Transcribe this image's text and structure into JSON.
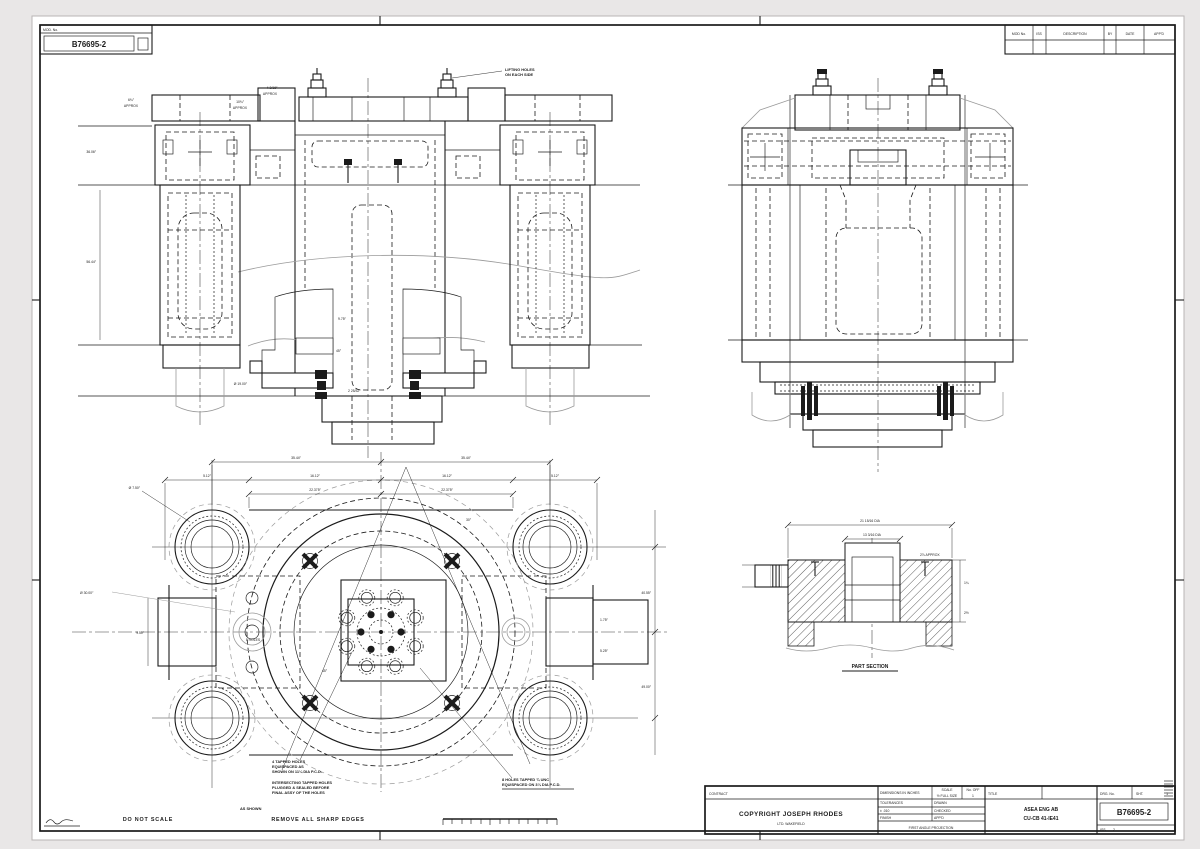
{
  "page": {
    "background": "#e9e7e7",
    "paper": "#ffffff",
    "ink": "#1b1b1b",
    "gray": "#9b9b9b"
  },
  "corner_box": {
    "label": "MOD. No.",
    "number": "B76695-2"
  },
  "revision_table": {
    "headers": [
      "MOD No.",
      "ISS",
      "DESCRIPTION",
      "BY",
      "DATE",
      "APP'D"
    ]
  },
  "title_block": {
    "contract_label": "CONTRACT",
    "copyright_line1": "COPYRIGHT JOSEPH RHODES",
    "copyright_line2": "LTD. WAKEFIELD",
    "dims_note": "DIMENSIONS IN INCHES",
    "scale_label": "SCALE",
    "scale_value": "½ FULL SIZE",
    "no_off_label": "No. OFF",
    "no_off_value": "1",
    "tol_label": "TOLERANCES",
    "tol_value": "± .010",
    "finish_label": "FINISH",
    "drawn_label": "DRAWN",
    "checked_label": "CHECKED",
    "approved_label": "APP'D",
    "projection_note": "FIRST ANGLE PROJECTION",
    "title_label": "TITLE",
    "customer_line1": "ASEA ENG AB",
    "customer_line2": "CU-CB 41-IE41",
    "drg_label": "DRG. No.",
    "drg_no": "B76695-2",
    "sheet_label": "SHT.",
    "sheet_value": "1",
    "issue_label": "ISS.",
    "issue_value": "2"
  },
  "footer": {
    "do_not_scale": "DO NOT SCALE",
    "remove_edges": "REMOVE ALL SHARP EDGES"
  },
  "notes": {
    "lifting": [
      "LIFTING HOLES",
      "ON EACH SIDE"
    ],
    "tapped": [
      "4 TAPPED HOLES",
      "EQUISPACED AS",
      "SHOWN ON 11¼ DIA P.C.D."
    ],
    "plugged": [
      "INTERSECTING TAPPED HOLES",
      "PLUGGED & SEALED BEFORE",
      "FINAL ASSY OF THE HOLES",
      "AS SHOWN"
    ],
    "holes8": [
      "8 HOLES TAPPED ¾ UNC",
      "EQUISPACED ON 3¼ DIA P.C.D."
    ]
  },
  "front_view": {
    "dims": {
      "approx1_a": "6¾″",
      "approx1_b": "APPROX",
      "approx2_a": "10¾″",
      "approx2_b": "APPROX",
      "approx3_a": "4 3/16″",
      "approx3_b": "APPROX",
      "left1": "36.06″",
      "left2": "56.44″",
      "g1": "9.75″",
      "g2": "45°",
      "g3": "2 25/32″",
      "g4": "Ø 19.00″"
    }
  },
  "plan_view": {
    "dims": {
      "t1a": "35.44″",
      "t1b": "35.44″",
      "t2a": "5.12″",
      "t2b": "16.12″",
      "t2c": "16.12″",
      "t2d": "5.12″",
      "t3a": "22.375″",
      "t3b": "22.375″",
      "lobe_dia": "Ø 7.50″",
      "main_dia": "Ø 30.00″",
      "lug_note": "5 HOLES",
      "ra": "1.75″",
      "rb": "5.25″",
      "v1": "40.55″",
      "v2": "49.00″",
      "a30": "30°",
      "a45": "45°",
      "left": "9.50″"
    }
  },
  "section_view": {
    "label": "PART SECTION",
    "dims": {
      "d1": "21 15/16 DIA",
      "d2": "13 3/16 DIA",
      "d3": "4¾",
      "approx": "2⅞ APPROX",
      "r1": "1¼",
      "r2": "2½"
    }
  }
}
